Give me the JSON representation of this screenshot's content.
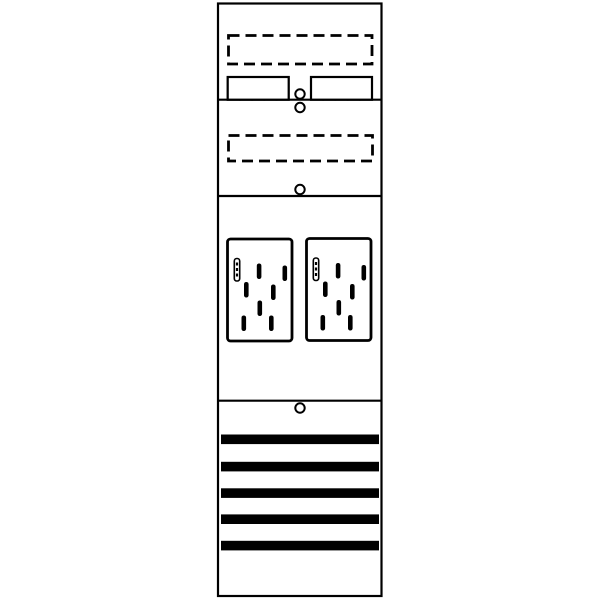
{
  "diagram": {
    "title": "Meter panel line drawing",
    "colors": {
      "line": "#000000",
      "background": "#ffffff"
    },
    "panel": {
      "sections": [
        {
          "id": "terminal-section",
          "dashed_reserve_boxes": 1,
          "terminal_groups": 2,
          "cells_per_group": 5,
          "screw_holes": 2
        },
        {
          "id": "reserve-section",
          "dashed_reserve_boxes": 1,
          "screw_holes": 1
        },
        {
          "id": "meter-section",
          "meter_plates": 2,
          "mounting_slots_per_plate": 7,
          "seal_slots_per_plate": 1,
          "screw_holes": 0
        },
        {
          "id": "busbar-section",
          "busbars": 5,
          "screw_holes": 1
        }
      ]
    }
  }
}
